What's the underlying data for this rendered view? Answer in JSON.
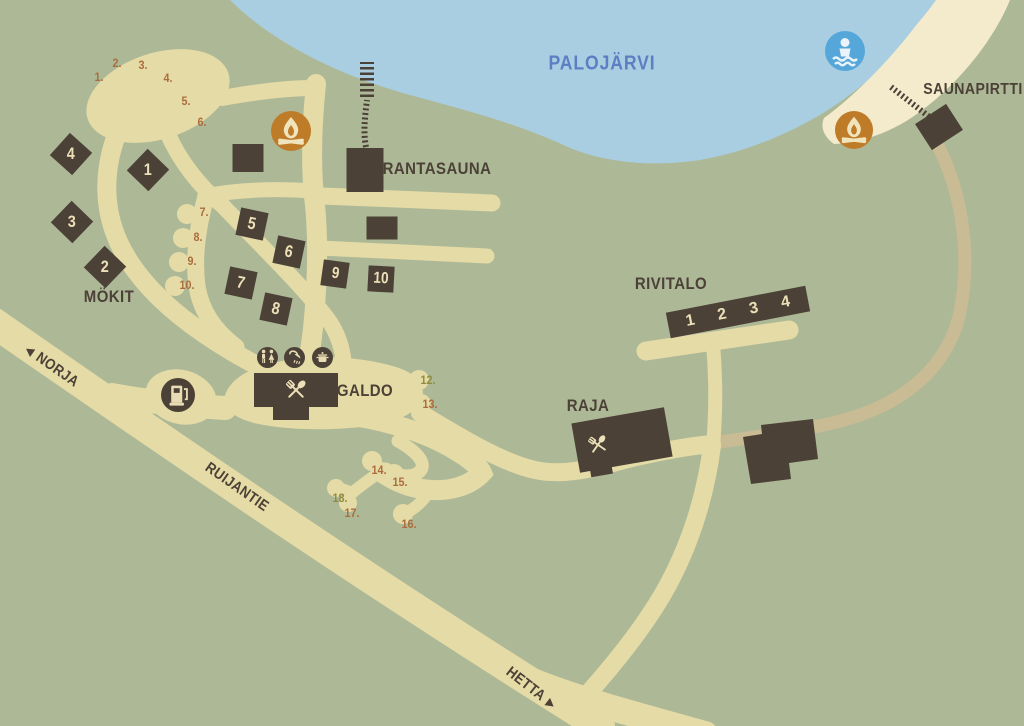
{
  "lake": {
    "label": "PALOJÄRVI"
  },
  "places": {
    "rantasauna": "RANTASAUNA",
    "saunapirtti": "SAUNAPIRTTI",
    "mokit": "MÖKIT",
    "galdo": "GALDO",
    "rivitalo": "RIVITALO",
    "raja": "RAJA"
  },
  "roads": {
    "norja": {
      "label": "NORJA",
      "arrow": "◀"
    },
    "ruijantie": {
      "label": "RUIJANTIE"
    },
    "hetta": {
      "label": "HETTA",
      "arrow": "▶"
    }
  },
  "cottages": [
    "1",
    "2",
    "3",
    "4",
    "5",
    "6",
    "7",
    "8",
    "9",
    "10"
  ],
  "rivitalo_units": [
    "1",
    "2",
    "3",
    "4"
  ],
  "pitches": [
    {
      "num": "1.",
      "color": "brown"
    },
    {
      "num": "2.",
      "color": "brown"
    },
    {
      "num": "3.",
      "color": "brown"
    },
    {
      "num": "4.",
      "color": "brown"
    },
    {
      "num": "5.",
      "color": "brown"
    },
    {
      "num": "6.",
      "color": "brown"
    },
    {
      "num": "7.",
      "color": "brown"
    },
    {
      "num": "8.",
      "color": "brown"
    },
    {
      "num": "9.",
      "color": "brown"
    },
    {
      "num": "10.",
      "color": "brown"
    },
    {
      "num": "12.",
      "color": "olive"
    },
    {
      "num": "13.",
      "color": "brown"
    },
    {
      "num": "14.",
      "color": "brown"
    },
    {
      "num": "15.",
      "color": "brown"
    },
    {
      "num": "16.",
      "color": "brown"
    },
    {
      "num": "17.",
      "color": "brown"
    },
    {
      "num": "18.",
      "color": "olive"
    }
  ],
  "icons": [
    "campfire-icon",
    "swimming-area-icon",
    "fuel-station-icon",
    "wc-icon",
    "shower-icon",
    "cooking-pot-icon",
    "restaurant-icon",
    "pier-icon"
  ],
  "colors": {
    "ground": "#adb897",
    "water": "#a9cee1",
    "beach": "#f4ebcd",
    "road": "#e5dba6",
    "dirt_path": "#c9bb93",
    "building": "#4c4137",
    "fire_orange": "#bf7c28",
    "swim_blue": "#55a6d9",
    "pitch_brown": "#ab6d3d",
    "pitch_olive": "#8f8c3f",
    "lake_label_blue": "#5d7ec3",
    "cream": "#ece0b8"
  }
}
